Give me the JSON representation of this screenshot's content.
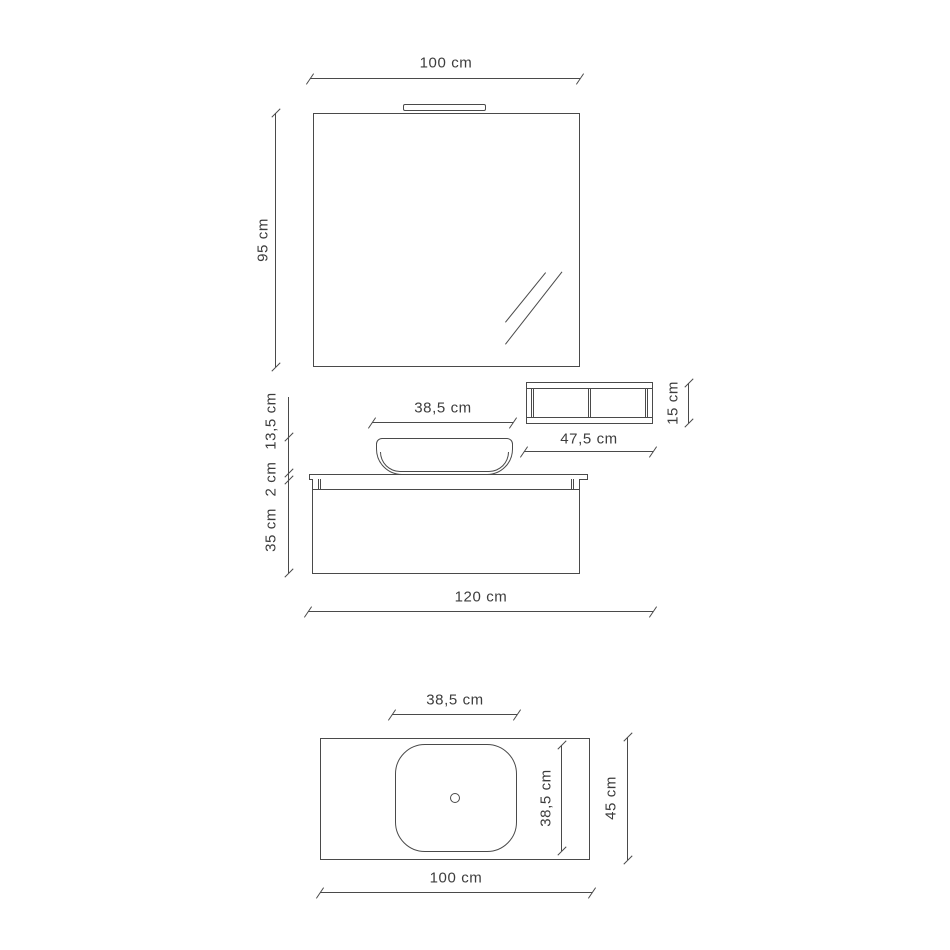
{
  "drawing_title": "Bathroom vanity composition technical drawing",
  "colors": {
    "line": "#4a4a4a",
    "text": "#3d3d3d",
    "background": "#ffffff"
  },
  "front_view": {
    "mirror_width": "100 cm",
    "mirror_height": "95 cm",
    "shelf_width": "47,5 cm",
    "shelf_height": "15 cm",
    "basin_width": "38,5 cm",
    "basin_height": "13,5 cm",
    "countertop_thickness": "2 cm",
    "cabinet_height": "35 cm",
    "total_width": "120 cm"
  },
  "top_view": {
    "basin_width": "38,5 cm",
    "basin_depth": "38,5 cm",
    "countertop_depth": "45 cm",
    "countertop_width": "100 cm"
  }
}
